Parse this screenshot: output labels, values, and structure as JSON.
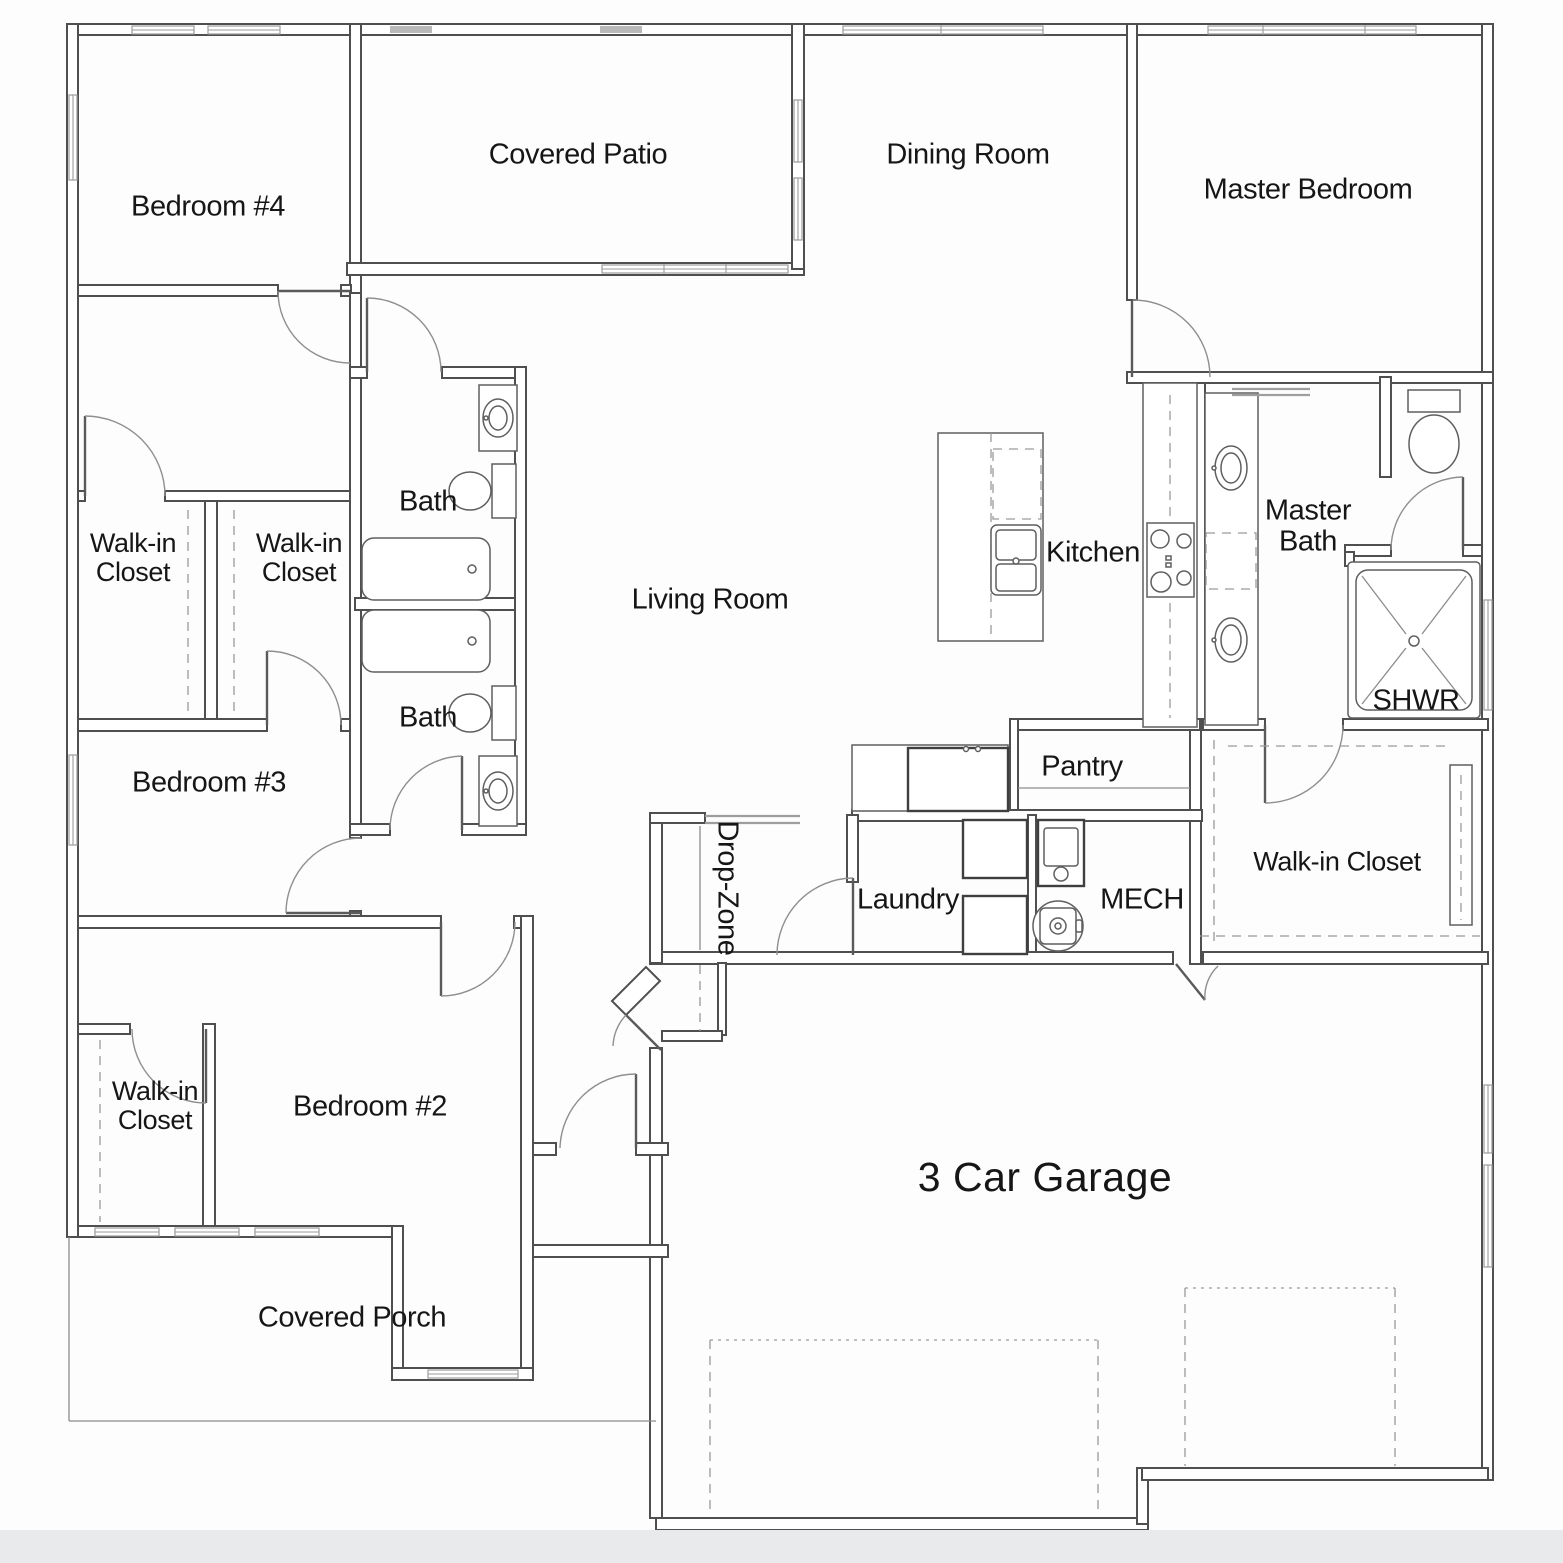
{
  "page": {
    "background": "#fdfdfe",
    "strip_color": "#e9eaec"
  },
  "colors": {
    "wall_stroke": "#4f4f4f",
    "fixture_line": "#5f5f5f",
    "window_line": "#9b9b9b",
    "text": "#161616"
  },
  "rooms": [
    {
      "id": "bedroom-4",
      "label": "Bedroom #4"
    },
    {
      "id": "covered-patio",
      "label": "Covered Patio"
    },
    {
      "id": "dining-room",
      "label": "Dining Room"
    },
    {
      "id": "master-bedroom",
      "label": "Master Bedroom"
    },
    {
      "id": "bath-upper",
      "label": "Bath"
    },
    {
      "id": "walkin-closet-b4",
      "label": "Walk-in\nCloset"
    },
    {
      "id": "walkin-closet-b3",
      "label": "Walk-in\nCloset"
    },
    {
      "id": "kitchen",
      "label": "Kitchen"
    },
    {
      "id": "master-bath",
      "label": "Master\nBath"
    },
    {
      "id": "living-room",
      "label": "Living Room"
    },
    {
      "id": "shower",
      "label": "SHWR"
    },
    {
      "id": "bath-lower",
      "label": "Bath"
    },
    {
      "id": "bedroom-3",
      "label": "Bedroom #3"
    },
    {
      "id": "pantry",
      "label": "Pantry"
    },
    {
      "id": "drop-zone",
      "label": "Drop-Zone"
    },
    {
      "id": "laundry",
      "label": "Laundry"
    },
    {
      "id": "mech",
      "label": "MECH"
    },
    {
      "id": "walkin-closet-master",
      "label": "Walk-in Closet"
    },
    {
      "id": "walkin-closet-b2",
      "label": "Walk-in\nCloset"
    },
    {
      "id": "bedroom-2",
      "label": "Bedroom #2"
    },
    {
      "id": "garage",
      "label": "3 Car Garage"
    },
    {
      "id": "covered-porch",
      "label": "Covered Porch"
    }
  ]
}
